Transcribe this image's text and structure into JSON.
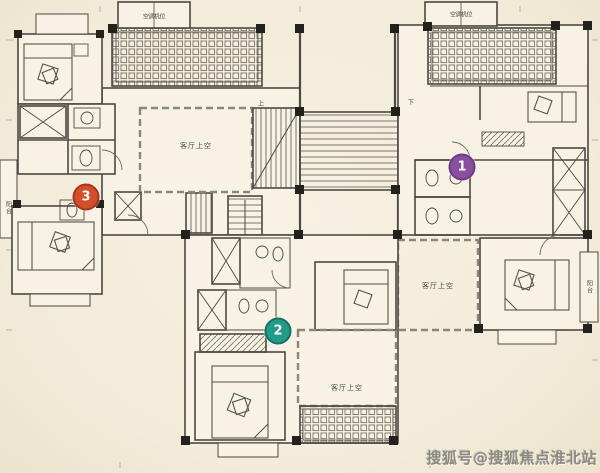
{
  "canvas": {
    "width": 600,
    "height": 473,
    "background": "#f2ebd9"
  },
  "plan": {
    "type": "residential-floor-plan",
    "markers": [
      {
        "number": "1",
        "color": "#8a4f9e"
      },
      {
        "number": "2",
        "color": "#239b8b"
      },
      {
        "number": "3",
        "color": "#d4502c"
      }
    ],
    "void_labels": [
      {
        "text": "客厅上空"
      },
      {
        "text": "客厅上空"
      },
      {
        "text": "客厅上空"
      }
    ],
    "balcony_labels": [
      {
        "text": "阳台"
      },
      {
        "text": "阳台"
      }
    ],
    "equipment_labels": [
      {
        "text": "空调机位"
      },
      {
        "text": "空调机位"
      }
    ],
    "stair_labels": [
      {
        "text": "上"
      },
      {
        "text": "下"
      }
    ],
    "watermark": {
      "text": "搜狐号@搜狐焦点淮北站",
      "color": "#8c8a80"
    }
  }
}
